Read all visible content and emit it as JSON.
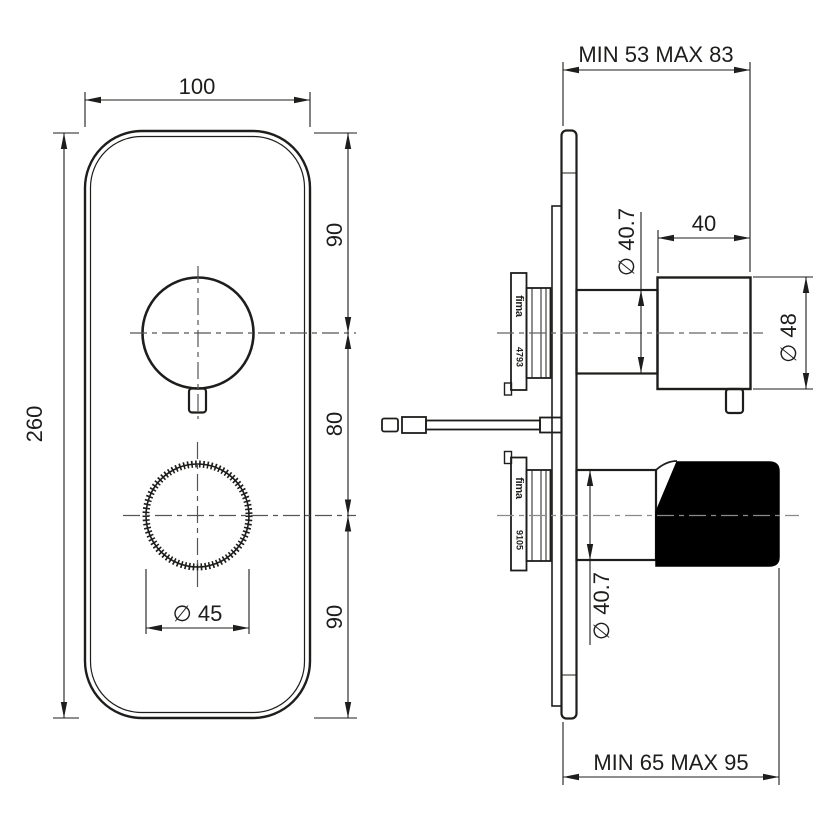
{
  "front_view": {
    "plate_width": "100",
    "plate_height": "260",
    "seg_top": "90",
    "seg_mid": "80",
    "seg_bottom": "90",
    "lower_knob_diameter": "∅ 45"
  },
  "side_view": {
    "wall_depth_top": "MIN 53 MAX 83",
    "wall_depth_bottom": "MIN 65 MAX 95",
    "upper_knob_length": "40",
    "upper_knob_diameter": "∅ 48",
    "upper_neck_diameter": "∅ 40.7",
    "lower_neck_diameter": "∅ 40.7",
    "upper_cartridge": {
      "brand": "fima",
      "code": "4793"
    },
    "lower_cartridge": {
      "brand": "fima",
      "code": "9105"
    }
  },
  "colors": {
    "line": "#1d1d1b",
    "centerline": "#6b6b6b",
    "knob_fill": "#000000",
    "background": "#ffffff"
  }
}
